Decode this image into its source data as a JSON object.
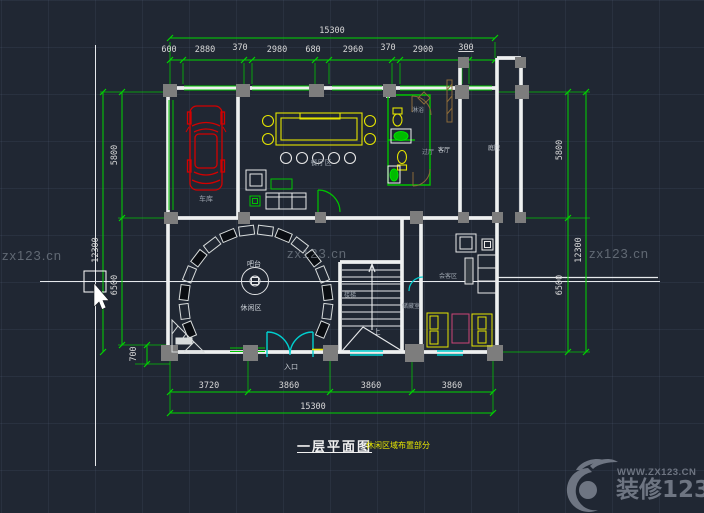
{
  "app": {
    "type": "cad-floorplan-viewport"
  },
  "colors": {
    "background": "#202733",
    "dimension_green": "#00d400",
    "wall_white": "#eef0f0",
    "window_cyan": "#00cfcf",
    "furniture_yellow": "#e4e400",
    "car_red": "#d40000",
    "table_pink": "#cc4477",
    "column_gray": "#7d7d7d",
    "door_brown": "#8a6a3a",
    "watermark_gray": "#6e7582",
    "title_yellow": "#e8e800"
  },
  "watermark": {
    "tile": "zx123.cn",
    "site": "WWW.ZX123.CN",
    "brand": "装修123"
  },
  "title": {
    "main": "一层平面图",
    "note": "休闲区域布置部分"
  },
  "dims": {
    "top_total": "15300",
    "top": [
      "600",
      "2880",
      "370",
      "2980",
      "680",
      "2960",
      "370",
      "2900",
      "300"
    ],
    "bottom": [
      "3720",
      "3860",
      "3860",
      "3860"
    ],
    "bottom_total": "15300",
    "left": {
      "total": "12300",
      "upper": "5800",
      "lower": "6500",
      "step": "700"
    },
    "right": {
      "upper": "5800",
      "lower": "6500",
      "total": "12300"
    }
  },
  "labels": {
    "garage": "车库",
    "dining": "餐厅区",
    "bar": "吧台",
    "leisure": "休闲区",
    "entrance": "入口",
    "up": "上",
    "stairs": "楼梯",
    "storage": "储藏室",
    "meeting": "会客区",
    "living": "客厅",
    "yard": "庭院",
    "shower": "淋浴",
    "hall": "过厅"
  }
}
